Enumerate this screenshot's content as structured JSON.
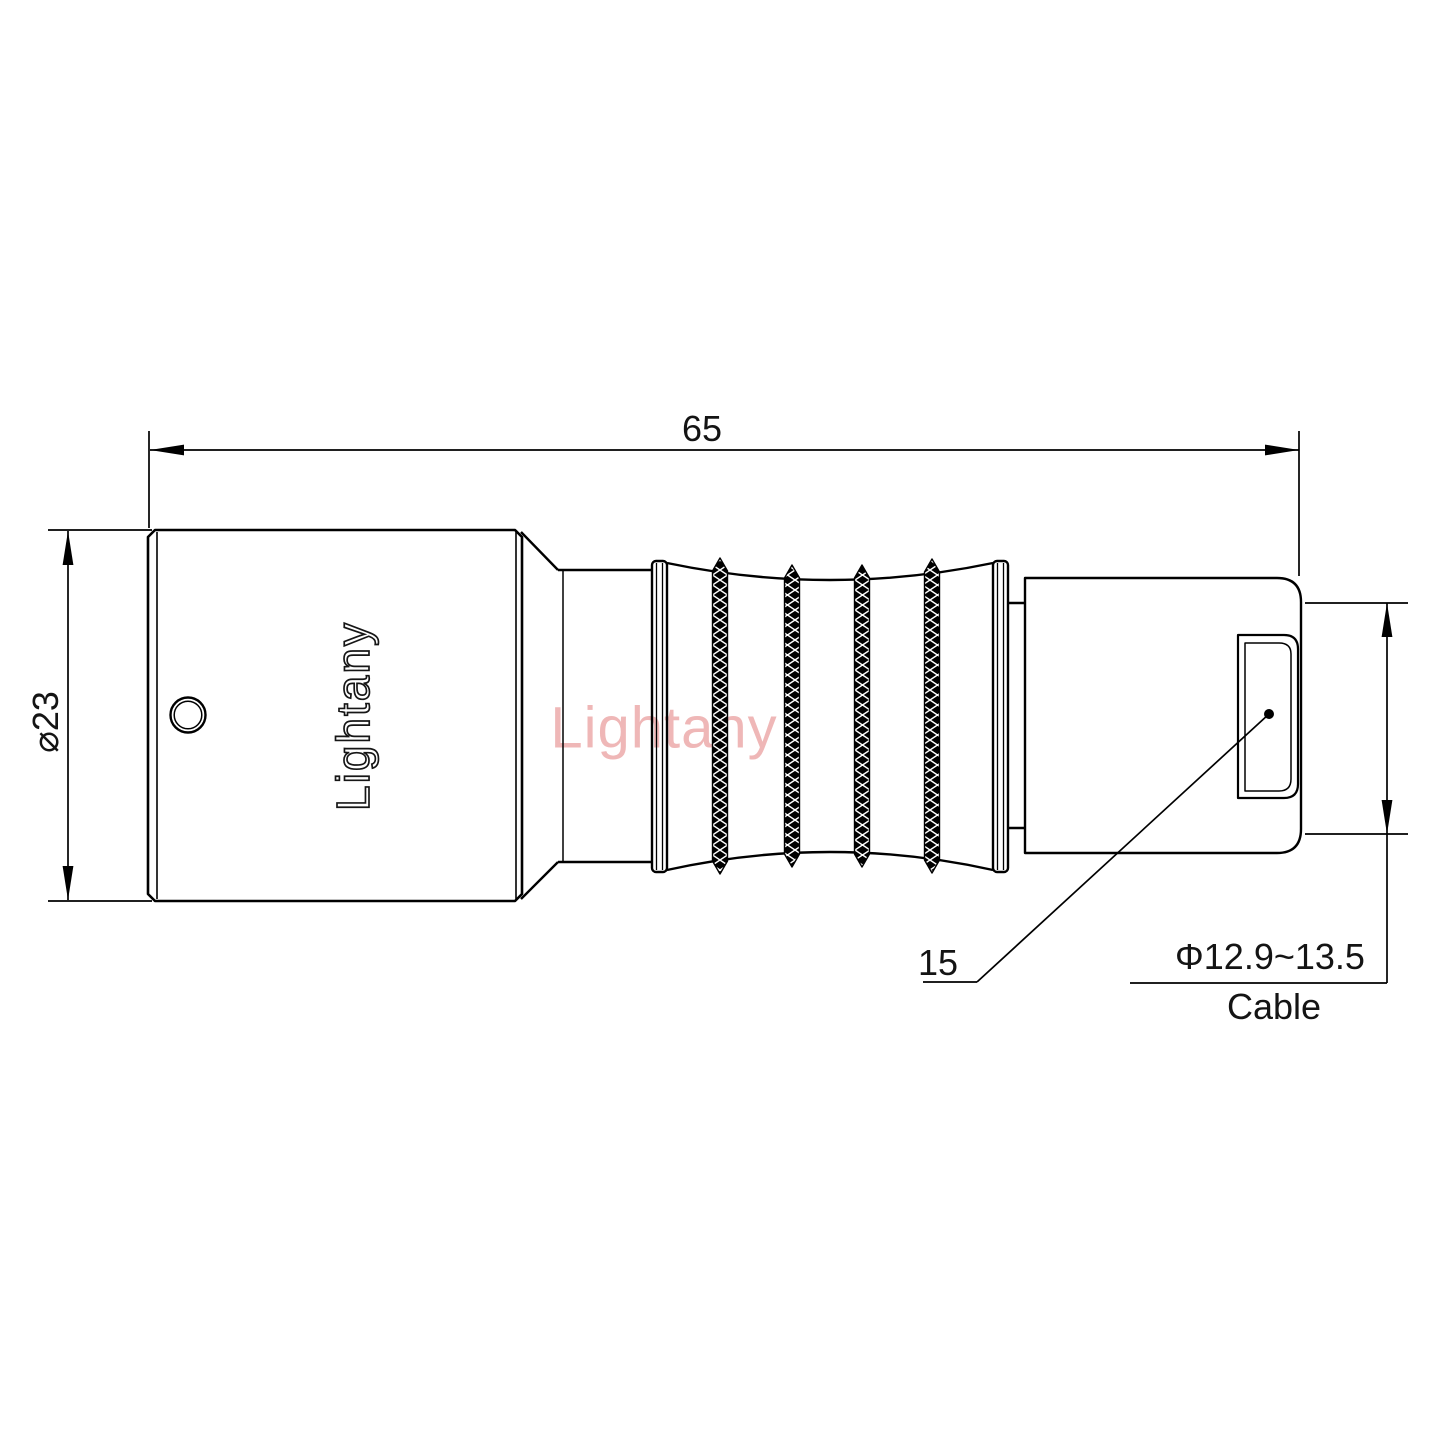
{
  "page": {
    "background": "#ffffff"
  },
  "labels": {
    "total_length": "65",
    "body_diameter": "⌀23",
    "rear_length": "15",
    "cable_diameter": "Φ12.9~13.5",
    "cable_caption": "Cable"
  },
  "engraving": {
    "brand": "Lightany"
  },
  "watermark": {
    "text": "Lightany",
    "color": "#efb7b7"
  },
  "colors": {
    "line": "#000000",
    "text": "#141414",
    "background": "#ffffff"
  }
}
